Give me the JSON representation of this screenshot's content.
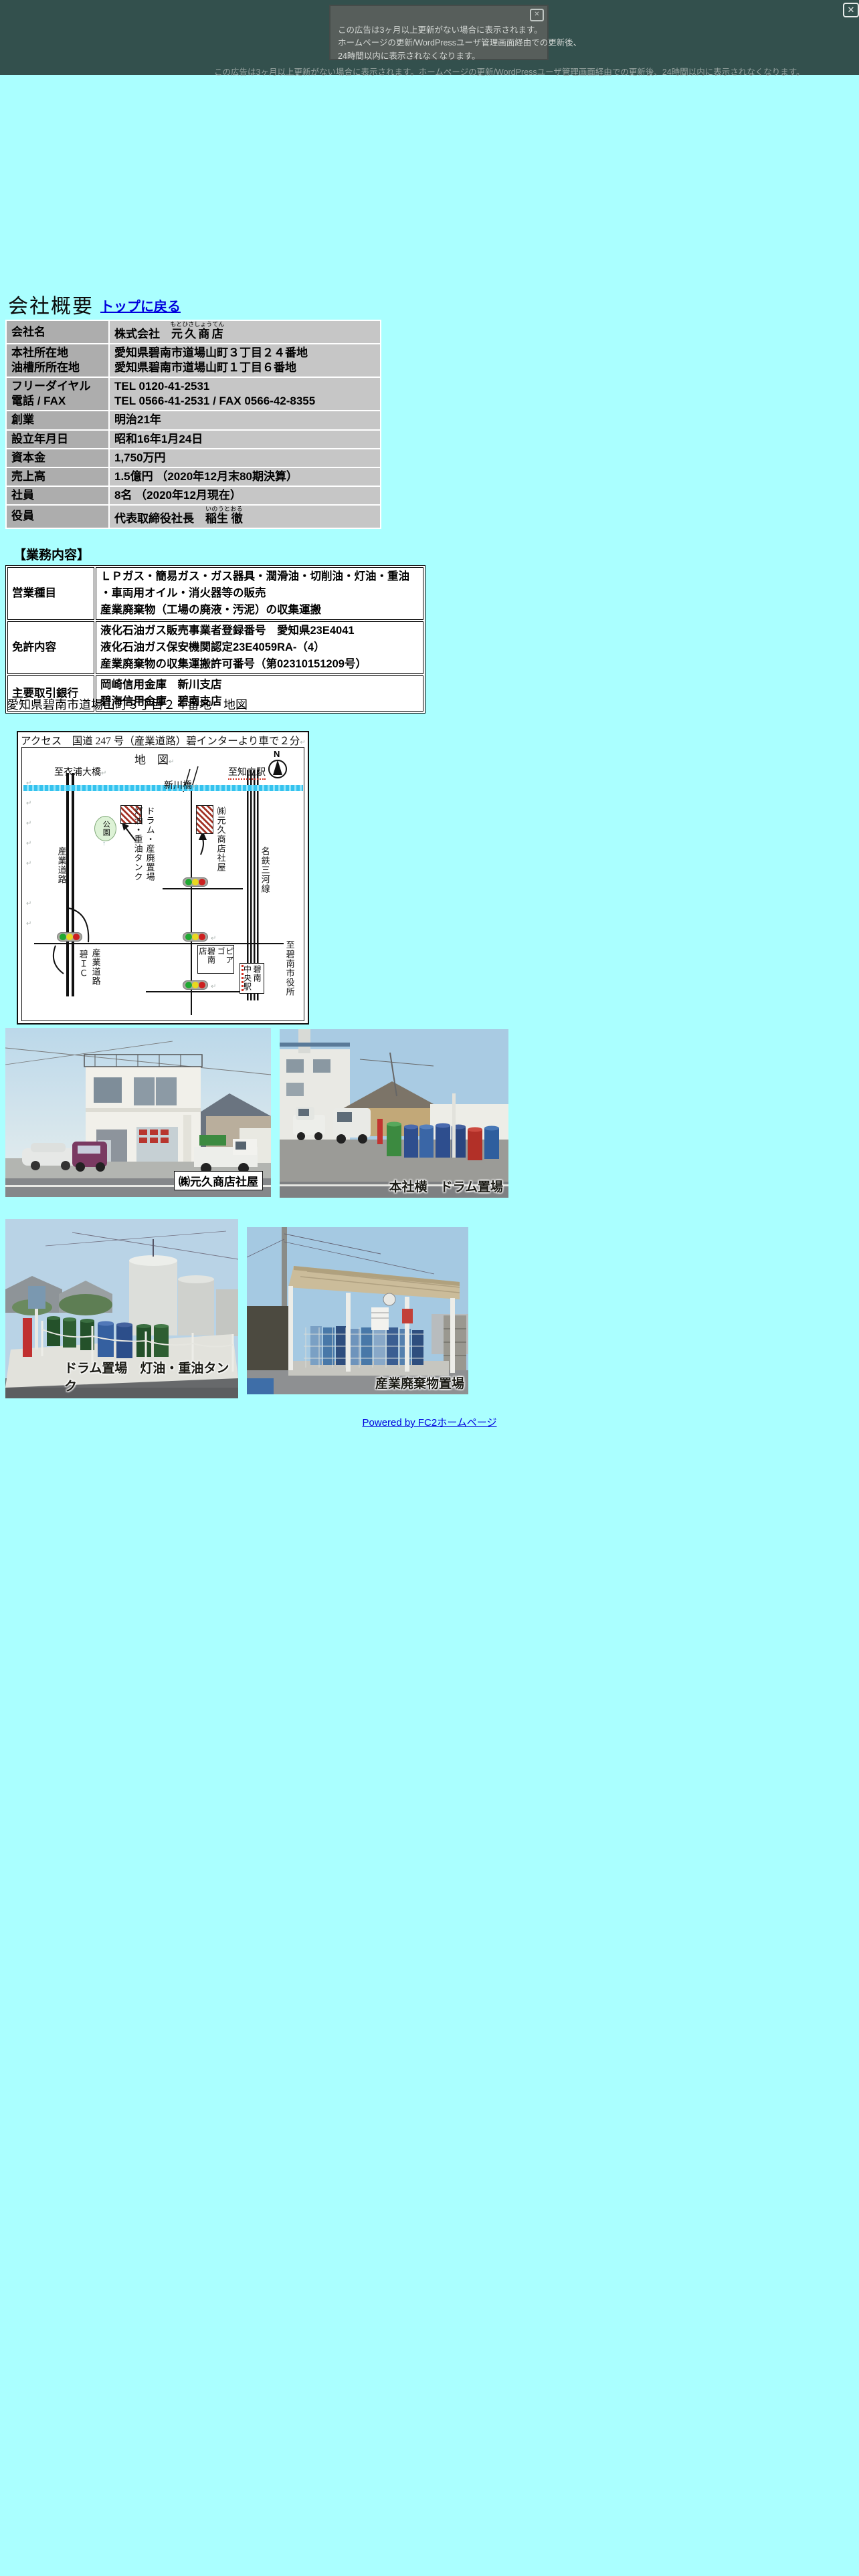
{
  "banner": {
    "close_x": "✕",
    "box_close_x": "✕",
    "line1": "この広告は3ヶ月以上更新がない場合に表示されます。",
    "line2": "ホームページの更新/WordPressユーザ管理画面経由での更新後、",
    "line3": "24時間以内に表示されなくなります。",
    "bottom_note": "この広告は3ヶ月以上更新がない場合に表示されます。ホームページの更新/WordPressユーザ管理画面経由での更新後、24時間以内に表示されなくなります。"
  },
  "page": {
    "title": "会社概要",
    "back_link": "トップに戻る"
  },
  "company": {
    "name_label": "会社名",
    "name_prefix": "株式会社",
    "name_ruby": "もとひさしょうてん",
    "name_main": "元久商店",
    "addr_label1": "本社所在地",
    "addr_label2": "油槽所所在地",
    "addr1": "愛知県碧南市道場山町３丁目２４番地",
    "addr2": "愛知県碧南市道場山町１丁目６番地",
    "tel_label1": "フリーダイヤル",
    "tel_label2": "電話 / FAX",
    "tel1": "TEL 0120-41-2531",
    "tel2": "TEL 0566-41-2531 / FAX 0566-42-8355",
    "founded_label": "創業",
    "founded": "明治21年",
    "established_label": "設立年月日",
    "established": "昭和16年1月24日",
    "capital_label": "資本金",
    "capital": "1,750万円",
    "sales_label": "売上高",
    "sales": "1.5億円 （2020年12月末80期決算）",
    "staff_label": "社員",
    "staff": "8名 （2020年12月現在）",
    "officer_label": "役員",
    "officer_title": "代表取締役社長",
    "officer_ruby": "いのうとおる",
    "officer_name": "稲生 徹"
  },
  "business": {
    "heading": "【業務内容】",
    "rows": [
      {
        "label": "営業種目",
        "lines": [
          "ＬＰガス・簡易ガス・ガス器具・潤滑油・切削油・灯油・重油",
          "・車両用オイル・消火器等の販売",
          "産業廃棄物（工場の廃液・汚泥）の収集運搬"
        ]
      },
      {
        "label": "免許内容",
        "lines": [
          "液化石油ガス販売事業者登録番号　愛知県23E4041",
          "液化石油ガス保安機関認定23E4059RA-（4）",
          "産業廃棄物の収集運搬許可番号（第02310151209号）"
        ]
      },
      {
        "label": "主要取引銀行",
        "lines": [
          "岡崎信用金庫　新川支店",
          "碧海信用金庫　碧南支店"
        ]
      }
    ]
  },
  "map": {
    "address_line": "愛知県碧南市道場山町３丁目２４番地　地図",
    "access": "アクセス　国道 247 号（産業道路）碧インターより車で２分",
    "title": "地　図",
    "north": "N",
    "to_kinuura": "至衣浦大橋",
    "to_chiryu": "至知立駅",
    "shinkawa_bridge": "新川橋",
    "park": "公園",
    "park_arrow": "↑",
    "drum_line1": "ドラム・産廃置場",
    "drum_line2": "灯油・重油タンク",
    "hq": "㈱元久商店社屋",
    "sangyo_road": "産業道路",
    "heki_ic": "碧ＩＣ",
    "piago_1": "ピアゴ",
    "piago_2": "碧南店",
    "station_1": "碧南",
    "station_2": "中央駅",
    "to_city_hall": "至碧南市役所",
    "meitetsu": "名鉄三河線",
    "pilcrow": "↵"
  },
  "photos": {
    "p1_caption": "㈱元久商店社屋",
    "p2_caption": "本社横　ドラム置場",
    "p3_caption": "ドラム置場　灯油・重油タンク",
    "p4_caption": "産業廃棄物置場"
  },
  "footer": {
    "powered_by": "Powered by FC2ホームページ"
  }
}
